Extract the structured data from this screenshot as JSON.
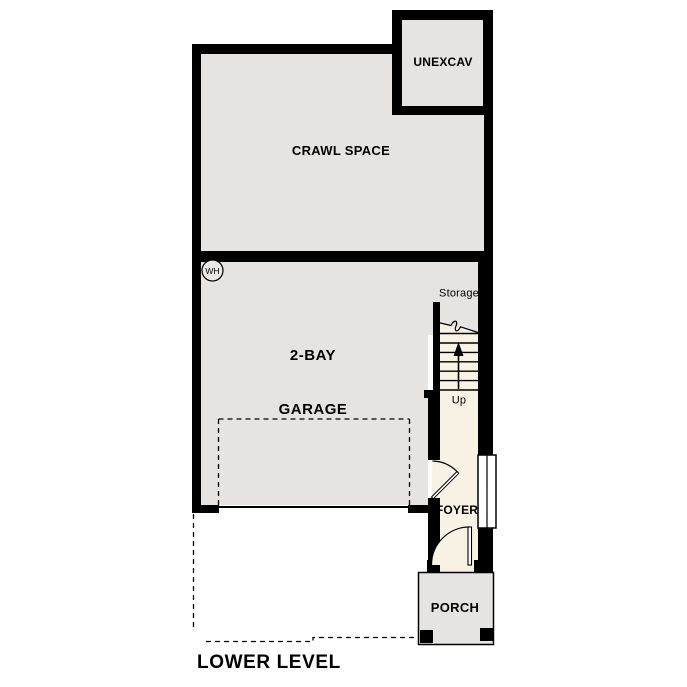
{
  "title": {
    "text": "LOWER LEVEL"
  },
  "rooms": {
    "unexcav": {
      "label": "UNEXCAV"
    },
    "crawl_space": {
      "label": "CRAWL SPACE"
    },
    "garage": {
      "line1": "2-BAY",
      "line2": "GARAGE"
    },
    "storage": {
      "label": "Storage"
    },
    "stairs": {
      "up_label": "Up"
    },
    "foyer": {
      "label": "FOYER"
    },
    "porch": {
      "label": "PORCH"
    },
    "water_heater": {
      "label": "WH"
    }
  },
  "colors": {
    "wall": "#000000",
    "room_fill": "#e5e4e2",
    "stair_fill": "#f8f2e5",
    "background": "#ffffff",
    "text": "#000000"
  }
}
